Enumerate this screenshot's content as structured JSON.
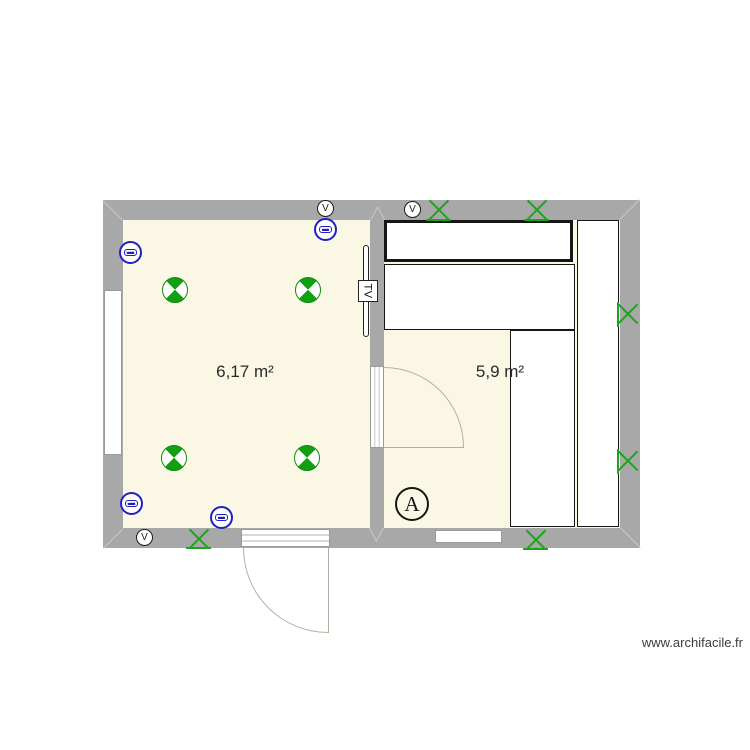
{
  "plan": {
    "watermark": "www.archifacile.fr",
    "rooms": [
      {
        "id": "room-left",
        "area_label": "6,17 m²"
      },
      {
        "id": "room-right",
        "area_label": "5,9 m²"
      }
    ],
    "labels": {
      "tv": "TV",
      "marker_a": "A"
    },
    "vents": [
      {
        "label": "V"
      },
      {
        "label": "V"
      },
      {
        "label": "V"
      }
    ],
    "outlets": [
      {
        "label": "USB"
      },
      {
        "label": "100"
      },
      {
        "label": "USB"
      },
      {
        "label": "100"
      }
    ],
    "colors": {
      "wall_gray": "#a8a8a8",
      "floor_beige": "#faf7e5",
      "symbol_green": "#12a012",
      "outlet_blue": "#2020c0",
      "door_arc": "#b9b1a2"
    }
  }
}
